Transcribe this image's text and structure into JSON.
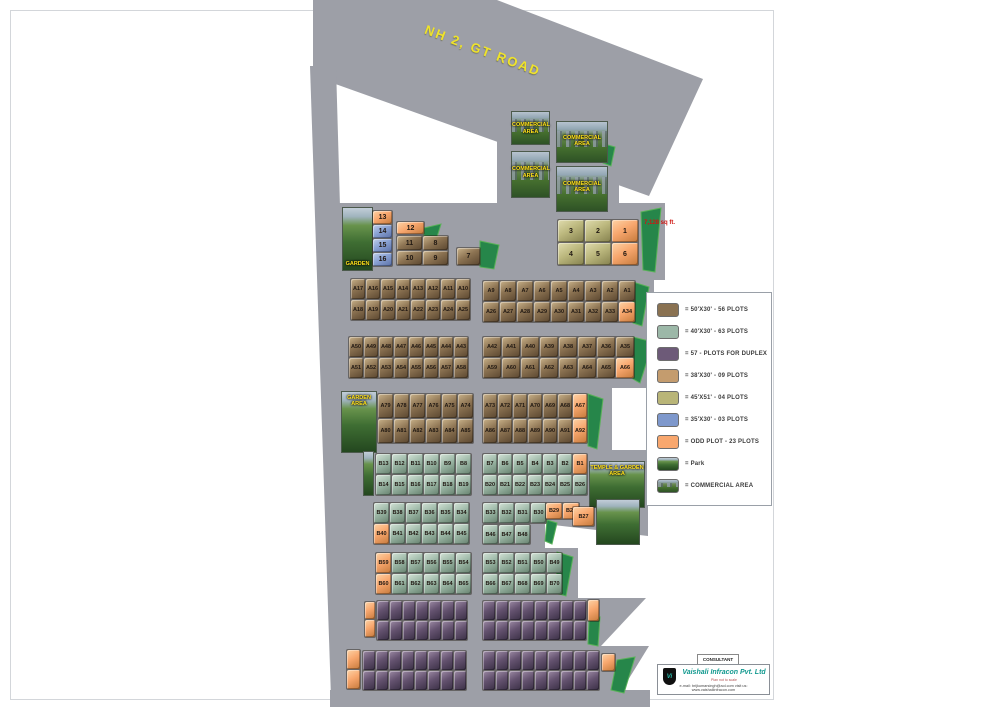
{
  "road": {
    "label": "NH 2, GT ROAD"
  },
  "areas": {
    "garden_label": "GARDEN",
    "garden_area_label": "GARDEN AREA",
    "temple_label": "TEMPLE & GARDEN AREA",
    "commercial_label": "COMMERCIAL AREA",
    "plot_note": "7,128 sq ft."
  },
  "site": {
    "blocks": [
      {
        "id": "top-blue-column",
        "color": "blue",
        "x": 372,
        "y": 210,
        "cw": 19,
        "ch": 13,
        "fs": 7,
        "orange": [
          "13"
        ],
        "rows": [
          [
            "13"
          ],
          [
            "14"
          ],
          [
            "15"
          ],
          [
            "16"
          ]
        ]
      },
      {
        "id": "top-plot-12",
        "color": "orange",
        "x": 396,
        "y": 221,
        "cw": 27,
        "ch": 12,
        "fs": 7,
        "rows": [
          [
            "12"
          ]
        ]
      },
      {
        "id": "top-brown-block",
        "color": "brown",
        "x": 396,
        "y": 235,
        "cw": 25,
        "ch": 14,
        "fs": 7,
        "rows": [
          [
            "11",
            "8"
          ],
          [
            "10",
            "9"
          ]
        ]
      },
      {
        "id": "top-plot-7",
        "color": "brown",
        "x": 456,
        "y": 247,
        "cw": 23,
        "ch": 17,
        "fs": 7,
        "rows": [
          [
            "7"
          ]
        ]
      },
      {
        "id": "top-olive-block",
        "color": "olive",
        "x": 557,
        "y": 219,
        "cw": 26,
        "ch": 22,
        "fs": 7,
        "orange": [
          "1",
          "6"
        ],
        "rows": [
          [
            "3",
            "2",
            "1"
          ],
          [
            "4",
            "5",
            "6"
          ]
        ]
      },
      {
        "id": "row1-left",
        "color": "brown",
        "x": 350,
        "y": 278,
        "cw": 14,
        "ch": 20,
        "rows": [
          [
            "A17",
            "A16",
            "A15",
            "A14",
            "A13",
            "A12",
            "A11",
            "A10"
          ],
          [
            "A18",
            "A19",
            "A20",
            "A21",
            "A22",
            "A23",
            "A24",
            "A25"
          ]
        ]
      },
      {
        "id": "row1-right",
        "color": "brown",
        "x": 482,
        "y": 280,
        "cw": 16,
        "ch": 20,
        "orange": [
          "A34"
        ],
        "rows": [
          [
            "A9",
            "A8",
            "A7",
            "A6",
            "A5",
            "A4",
            "A3",
            "A2",
            "A1"
          ],
          [
            "A26",
            "A27",
            "A28",
            "A29",
            "A30",
            "A31",
            "A32",
            "A33",
            "A34"
          ]
        ]
      },
      {
        "id": "row2-left",
        "color": "brown",
        "x": 348,
        "y": 336,
        "cw": 14,
        "ch": 20,
        "rows": [
          [
            "A50",
            "A49",
            "A48",
            "A47",
            "A46",
            "A45",
            "A44",
            "A43"
          ],
          [
            "A51",
            "A52",
            "A53",
            "A54",
            "A55",
            "A56",
            "A57",
            "A58"
          ]
        ]
      },
      {
        "id": "row2-right",
        "color": "brown",
        "x": 482,
        "y": 336,
        "cw": 18,
        "ch": 20,
        "orange": [
          "A66"
        ],
        "rows": [
          [
            "A42",
            "A41",
            "A40",
            "A39",
            "A38",
            "A37",
            "A36",
            "A35"
          ],
          [
            "A59",
            "A60",
            "A61",
            "A62",
            "A63",
            "A64",
            "A65",
            "A66"
          ]
        ]
      },
      {
        "id": "row3-left",
        "color": "brown",
        "x": 377,
        "y": 393,
        "cw": 15,
        "ch": 24,
        "rows": [
          [
            "A79",
            "A78",
            "A77",
            "A76",
            "A75",
            "A74"
          ],
          [
            "A80",
            "A81",
            "A82",
            "A83",
            "A84",
            "A85"
          ]
        ]
      },
      {
        "id": "row3-right",
        "color": "brown",
        "x": 482,
        "y": 393,
        "cw": 14,
        "ch": 24,
        "orange": [
          "A67",
          "A92"
        ],
        "rows": [
          [
            "A73",
            "A72",
            "A71",
            "A70",
            "A69",
            "A68",
            "A67"
          ],
          [
            "A86",
            "A87",
            "A88",
            "A89",
            "A90",
            "A91",
            "A92"
          ]
        ]
      },
      {
        "id": "row4-left",
        "color": "green",
        "x": 375,
        "y": 453,
        "cw": 15,
        "ch": 20,
        "rows": [
          [
            "B13",
            "B12",
            "B11",
            "B10",
            "B9",
            "B8"
          ],
          [
            "B14",
            "B15",
            "B16",
            "B17",
            "B18",
            "B19"
          ]
        ]
      },
      {
        "id": "row4-right",
        "color": "green",
        "x": 482,
        "y": 453,
        "cw": 14,
        "ch": 20,
        "orange": [
          "B1"
        ],
        "rows": [
          [
            "B7",
            "B6",
            "B5",
            "B4",
            "B3",
            "B2",
            "B1"
          ],
          [
            "B20",
            "B21",
            "B22",
            "B23",
            "B24",
            "B25",
            "B26"
          ]
        ]
      },
      {
        "id": "row5-left",
        "color": "green",
        "x": 373,
        "y": 502,
        "cw": 15,
        "ch": 20,
        "orange": [
          "B40"
        ],
        "rows": [
          [
            "B39",
            "B38",
            "B37",
            "B36",
            "B35",
            "B34"
          ],
          [
            "B40",
            "B41",
            "B42",
            "B43",
            "B44",
            "B45"
          ]
        ]
      },
      {
        "id": "row5-right-top",
        "color": "green",
        "x": 482,
        "y": 502,
        "cw": 15,
        "ch": 20,
        "rows": [
          [
            "B33",
            "B32",
            "B31",
            "B30"
          ]
        ]
      },
      {
        "id": "row5-right-bottom",
        "color": "green",
        "x": 482,
        "y": 524,
        "cw": 15,
        "ch": 19,
        "rows": [
          [
            "B46",
            "B47",
            "B48"
          ]
        ]
      },
      {
        "id": "odd-b29-b28",
        "color": "orange",
        "x": 545,
        "y": 502,
        "cw": 16,
        "ch": 16,
        "rows": [
          [
            "B29",
            "B28"
          ]
        ]
      },
      {
        "id": "odd-b27",
        "color": "orange",
        "x": 572,
        "y": 506,
        "cw": 21,
        "ch": 19,
        "rows": [
          [
            "B27"
          ]
        ]
      },
      {
        "id": "row6-left",
        "color": "green",
        "x": 375,
        "y": 552,
        "cw": 15,
        "ch": 20,
        "orange": [
          "B59",
          "B60"
        ],
        "rows": [
          [
            "B59",
            "B58",
            "B57",
            "B56",
            "B55",
            "B54"
          ],
          [
            "B60",
            "B61",
            "B62",
            "B63",
            "B64",
            "B65"
          ]
        ]
      },
      {
        "id": "row6-right",
        "color": "green",
        "x": 482,
        "y": 552,
        "cw": 15,
        "ch": 20,
        "rows": [
          [
            "B53",
            "B52",
            "B51",
            "B50",
            "B49"
          ],
          [
            "B66",
            "B67",
            "B68",
            "B69",
            "B70"
          ]
        ]
      },
      {
        "id": "duplex-row7-left",
        "color": "purple",
        "x": 376,
        "y": 600,
        "cw": 12,
        "ch": 19,
        "rows": [
          [
            "",
            "",
            "",
            "",
            "",
            "",
            ""
          ],
          [
            "",
            "",
            "",
            "",
            "",
            "",
            ""
          ]
        ]
      },
      {
        "id": "duplex-row7-right",
        "color": "purple",
        "x": 482,
        "y": 600,
        "cw": 12,
        "ch": 19,
        "rows": [
          [
            "",
            "",
            "",
            "",
            "",
            "",
            "",
            ""
          ],
          [
            "",
            "",
            "",
            "",
            "",
            "",
            "",
            ""
          ]
        ]
      },
      {
        "id": "duplex-row8-left",
        "color": "purple",
        "x": 362,
        "y": 650,
        "cw": 12,
        "ch": 19,
        "rows": [
          [
            "",
            "",
            "",
            "",
            "",
            "",
            "",
            ""
          ],
          [
            "",
            "",
            "",
            "",
            "",
            "",
            "",
            ""
          ]
        ]
      },
      {
        "id": "duplex-row8-right",
        "color": "purple",
        "x": 482,
        "y": 650,
        "cw": 12,
        "ch": 19,
        "rows": [
          [
            "",
            "",
            "",
            "",
            "",
            "",
            "",
            "",
            ""
          ],
          [
            "",
            "",
            "",
            "",
            "",
            "",
            "",
            "",
            ""
          ]
        ]
      },
      {
        "id": "odd-row7-left",
        "color": "orange",
        "x": 364,
        "y": 601,
        "cw": 10,
        "ch": 17,
        "rows": [
          [
            ""
          ],
          [
            ""
          ]
        ]
      },
      {
        "id": "odd-row7-right",
        "color": "orange",
        "x": 587,
        "y": 599,
        "cw": 11,
        "ch": 21,
        "rows": [
          [
            ""
          ]
        ]
      },
      {
        "id": "odd-row8-left",
        "color": "orange",
        "x": 346,
        "y": 649,
        "cw": 13,
        "ch": 19,
        "rows": [
          [
            ""
          ],
          [
            ""
          ]
        ]
      },
      {
        "id": "odd-row8-right",
        "color": "orange",
        "x": 601,
        "y": 653,
        "cw": 13,
        "ch": 17,
        "rows": [
          [
            ""
          ]
        ]
      }
    ]
  },
  "legend": {
    "items": [
      {
        "swatch": "#8a7252",
        "label": "= 50'X30' - 56 PLOTS"
      },
      {
        "swatch": "#9cb8a8",
        "label": "= 40'X30' - 63 PLOTS"
      },
      {
        "swatch": "#6d5a78",
        "label": "= 57 - PLOTS FOR DUPLEX"
      },
      {
        "swatch": "#c49c6e",
        "label": "= 38'X30' - 09 PLOTS"
      },
      {
        "swatch": "#b9b578",
        "label": "= 45'X51' - 04 PLOTS"
      },
      {
        "swatch": "#7e98cc",
        "label": "= 35'X30' - 03 PLOTS"
      },
      {
        "swatch": "#f8a76e",
        "label": "= ODD PLOT - 23 PLOTS"
      },
      {
        "swatch": "park",
        "label": "= Park"
      },
      {
        "swatch": "commercial",
        "label": "= COMMERCIAL AREA"
      }
    ]
  },
  "consultant": {
    "heading": "CONSULTANT",
    "logo_monogram": "Vi",
    "company": "Vaishali Infracon Pvt. Ltd",
    "tagline": "Plan not to scale",
    "contact": "e-mail: brijkumarsingh@aol.com   visit us: www.vaishaliinfracon.com"
  }
}
